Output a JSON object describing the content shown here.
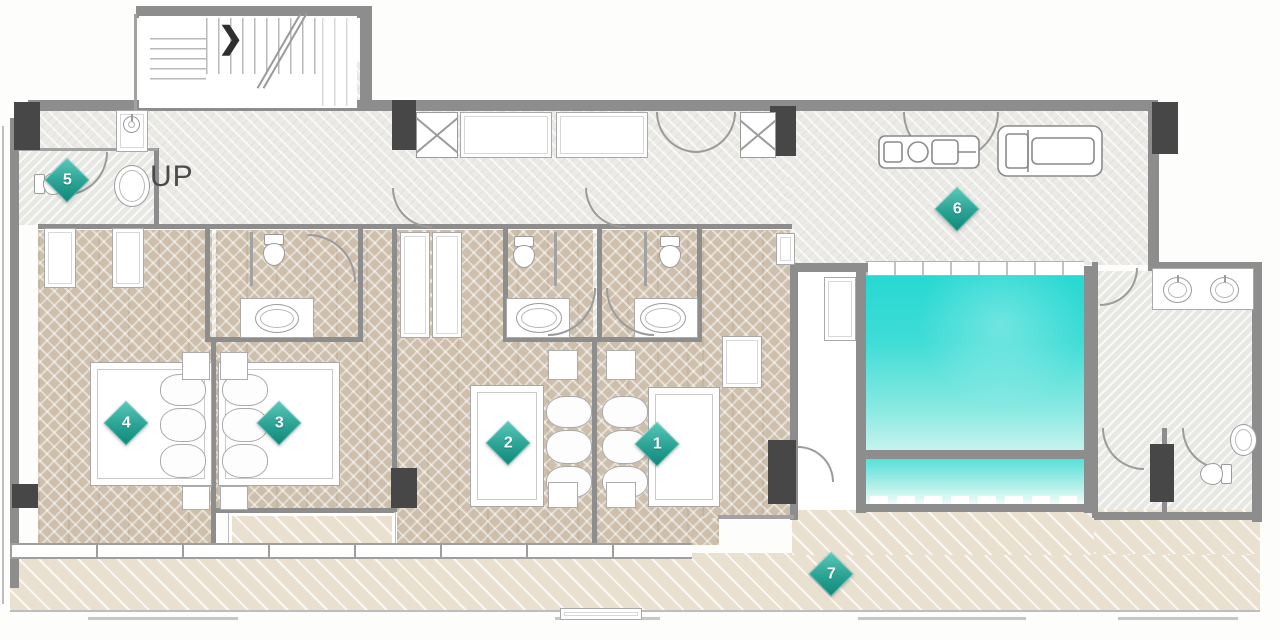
{
  "floor_plan": {
    "type": "residential-floor-plan",
    "stairs": {
      "label": "UP",
      "direction_glyph": "❯"
    },
    "markers": [
      {
        "label": "1",
        "area": "bedroom-1"
      },
      {
        "label": "2",
        "area": "bedroom-2"
      },
      {
        "label": "3",
        "area": "bedroom-3"
      },
      {
        "label": "4",
        "area": "bedroom-4"
      },
      {
        "label": "5",
        "area": "powder-room"
      },
      {
        "label": "6",
        "area": "gym"
      },
      {
        "label": "7",
        "area": "terrace"
      }
    ],
    "palette": {
      "accent_teal": "#1f9e90",
      "pool_water_top": "#27d8d2",
      "pool_water_bottom": "#c7f3ee",
      "wall_gray": "#8d8d8d",
      "column_dark": "#474747",
      "wood_floor": "#cdbfab",
      "deck_floor": "#e9e0cf",
      "hall_floor": "#ebeae7"
    }
  }
}
